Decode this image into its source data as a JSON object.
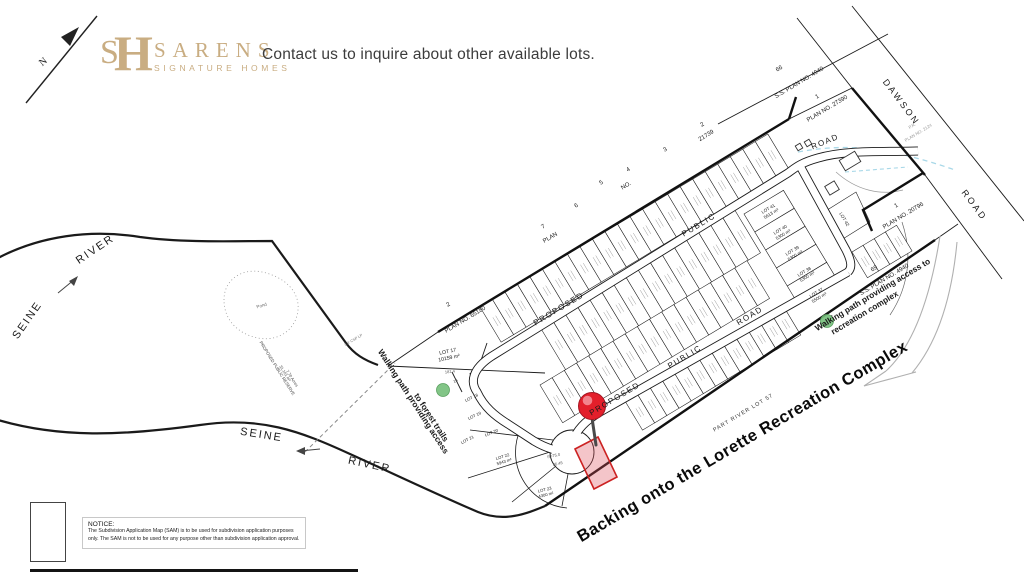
{
  "header": {
    "north_label": "N",
    "logo": {
      "monogram_s": "S",
      "monogram_h": "H",
      "name": "SARENS",
      "tagline": "SIGNATURE HOMES"
    },
    "contact_text": "Contact us to inquire about other available lots."
  },
  "map": {
    "rivers": {
      "seine_upper": "SEINE",
      "river_upper": "RIVER",
      "seine_lower": "SEINE",
      "river_lower": "RIVER"
    },
    "pond": "Pond",
    "reserve": {
      "l1": "PROPOSED PUBLIC RESERVE",
      "l2": "31,161 m²",
      "l3": "7.70 Acres"
    },
    "paths": {
      "forest_l1": "Walking path providing access",
      "forest_l2": "to forest trails",
      "rec_l1": "Walking path providing access to",
      "rec_l2": "recreation complex"
    },
    "backing": "Backing onto the Lorette Recreation Complex",
    "part_river_lot": "PART RIVER LOT 57",
    "roads": {
      "upper": [
        "PROPOSED",
        "PUBLIC",
        "ROAD"
      ],
      "middle": [
        "PROPOSED",
        "PUBLIC",
        "ROAD"
      ],
      "dawson": [
        "DAWSON",
        "ROAD"
      ]
    },
    "plans": {
      "p65180_num": "2",
      "p65180": "PLAN NO. 65180",
      "p21739_plan": "PLAN",
      "p21739_no": "NO.",
      "p21739_num": "21739",
      "p21739_lots": [
        "7",
        "6",
        "5",
        "4",
        "3",
        "2"
      ],
      "ss4940_top_num": "66",
      "ss4940_top": "S.S. PLAN NO. 4940",
      "p27390_num": "1",
      "p27390": "PLAN NO. 27390",
      "p2124_pr": "P.R.",
      "p2124": "PLAN NO. 2124",
      "p20796_num": "1",
      "p20796": "PLAN NO. 20796",
      "ss4940_bot_num": "69",
      "ss4940_bot": "S.S. PLAN NO. 4940"
    },
    "lots": {
      "lot17": {
        "name": "LOT 17",
        "area": "10159 m²"
      },
      "lot18": {
        "name": "LOT 18"
      },
      "lot19": {
        "name": "LOT 19"
      },
      "lot20": {
        "name": "LOT 20"
      },
      "lot21": {
        "name": "LOT 21"
      },
      "lot22": {
        "name": "LOT 22",
        "area": "5943 m²"
      },
      "lot23": {
        "name": "LOT 23",
        "area": "4300 m²"
      },
      "lot37": {
        "name": "LOT 37",
        "area": "5500 m²"
      },
      "lot38": {
        "name": "LOT 38",
        "area": "5300 m²"
      },
      "lot39": {
        "name": "LOT 39",
        "area": "5300 m²"
      },
      "lot40": {
        "name": "LOT 40",
        "area": "5300 m²"
      },
      "lot41": {
        "name": "LOT 41",
        "area": "5613 m²"
      },
      "lot42": {
        "name": "LOT 42"
      }
    },
    "dims": {
      "d181": "181.4",
      "r75": "R=75.0",
      "d3645": "36.45",
      "csp": "3.4' CSP LP",
      "lot16": "16"
    }
  },
  "notice": {
    "title": "NOTICE:",
    "line1": "The Subdivision Application Map (SAM) is to be used for subdivision application purposes",
    "line2": "only. The SAM is not to be used for any purpose other than subdivision application approval."
  },
  "colors": {
    "brand_tan": "#c9ad82",
    "pin_red": "#e31f2b",
    "lot_highlight": "#cc2222",
    "path_green": "#74bf7a",
    "water_blue": "#a8d8e8"
  }
}
